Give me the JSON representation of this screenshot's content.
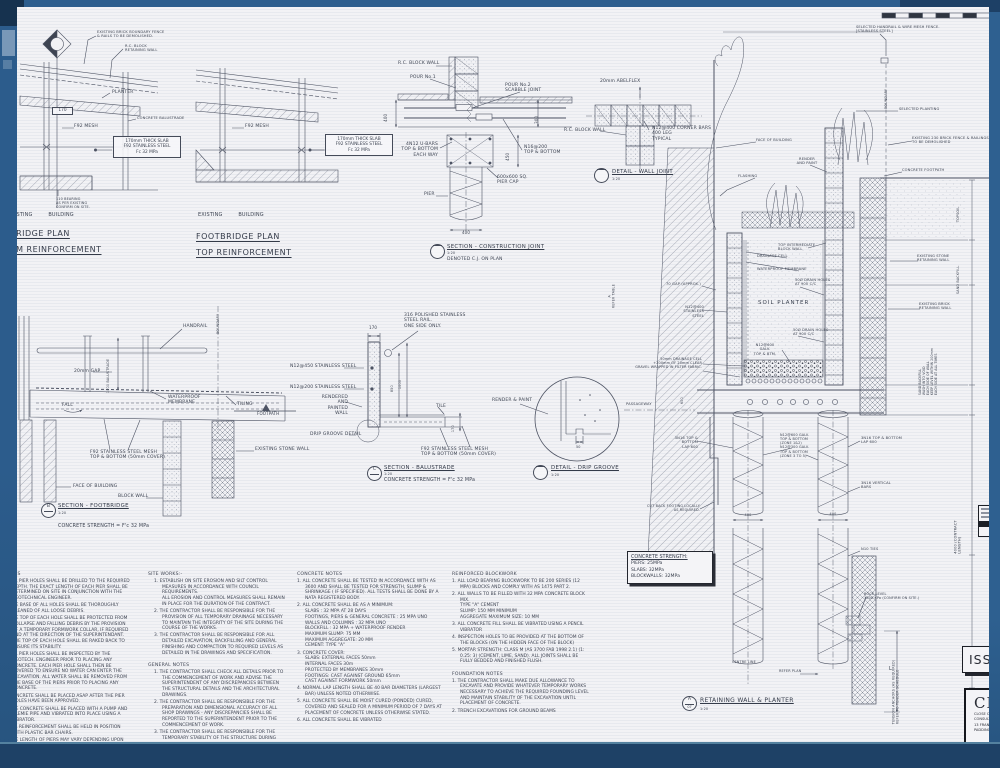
{
  "frame": {
    "border_color": "#2d5e8e",
    "dark_color": "#16324f",
    "paper_color": "#f2f2f5",
    "ink_color": "#3d4452"
  },
  "plan_bottom": {
    "callout_fence": "EXISTING BRICK BOUNDARY FENCE\n& RAILS TO BE DEMOLISHED.",
    "callout_rc_wall": "R.C. BLOCK\nRETAINING WALL",
    "label_planter": "PLANTER",
    "dim_thickness": "170",
    "label_mesh": "F92 MESH",
    "callout_balustrade": "CONCRETE BALUSTRADE",
    "note_slab": "170mm THICK SLAB\nF92 STAINLESS STEEL\nFc 32 MPa",
    "callout_bearing": "110 BEARING\nAS PER EXISTING\nCONFIRM ON SITE.",
    "label_existing_building": "EXISTING BUILDING",
    "title": "FOOTBRIDGE PLAN",
    "subtitle": "BOTTOM REINFORCEMENT"
  },
  "plan_top": {
    "label_mesh": "F92 MESH",
    "note_slab": "170mm THICK SLAB\nF92 STAINLESS STEEL\nFc 32 MPa",
    "label_existing_building": "EXISTING BUILDING",
    "title": "FOOTBRIDGE PLAN",
    "subtitle": "TOP REINFORCEMENT"
  },
  "section_cj": {
    "callout_wall": "R.C. BLOCK WALL",
    "callout_pour1": "POUR No.1",
    "callout_pour2": "POUR No.2\nSCABBLE JOINT",
    "callout_ubars": "4N12 U-BARS\nTOP & BOTTOM\nEACH WAY",
    "callout_n16": "N16@200\nTOP & BOTTOM",
    "callout_piercap": "600x600 SQ.\nPIER CAP",
    "callout_pier": "PIER",
    "dim_400": "400",
    "dim_300": "300",
    "dim_450": "450",
    "dim_400b": "400",
    "title": "SECTION - CONSTRUCTION JOINT",
    "scale": "1:20",
    "note": "DENOTED C.J. ON PLAN"
  },
  "detail_wall_joint": {
    "callout_abelflex": "20mm ABELFLEX",
    "callout_wall": "R.C. BLOCK WALL",
    "callout_corner_bars": "N12@400 CORNER BARS\n400 LEG\nTYPICAL",
    "title": "DETAIL - WALL JOINT",
    "scale": "1:20"
  },
  "section_footbridge": {
    "callout_handrail": "HANDRAIL",
    "label_boundary": "BOUNDARY",
    "callout_gap": "20mm GAP",
    "dim_balustrade": "1000 BALUSTRADE",
    "label_fall": "FALL",
    "callout_membrane": "WATERPROOF\nMEMBRANE",
    "callout_tiling": "TILING",
    "label_footpath": "FOOTPATH",
    "callout_mesh": "F92 STAINLESS STEEL MESH\nTOP & BOTTOM (50mm COVER)",
    "callout_face": "FACE OF BUILDING",
    "callout_blockwall": "BLOCK WALL",
    "callout_stonewall": "EXISTING STONE WALL",
    "bubble_letter": "B",
    "title": "SECTION - FOOTBRIDGE",
    "scale": "1:20",
    "strength": "CONCRETE STRENGTH = F'c 32 MPa"
  },
  "section_balustrade": {
    "callout_rail": "316 POLISHED STAINLESS\nSTEEL RAIL.\nONE SIDE ONLY.",
    "dim_top": "170",
    "callout_n12_450": "N12@450 STAINLESS STEEL",
    "callout_n12_200": "N12@200 STAINLESS STEEL",
    "callout_rendered": "RENDERED AND\nPAINTED WALL",
    "dim_850": "850",
    "dim_1000": "1000",
    "callout_drip": "DRIP GROOVE DETAIL",
    "callout_tile": "TILE",
    "dim_170": "170",
    "callout_mesh": "F92 STAINLESS STEEL MESH\nTOP & BOTTOM (50mm COVER)",
    "bubble_letter": "C",
    "title": "SECTION - BALUSTRADE",
    "scale": "1:20",
    "strength": "CONCRETE STRENGTH = F'c 32 MPa"
  },
  "detail_drip": {
    "callout_render": "RENDER & PAINT",
    "dim_50": "50",
    "title": "DETAIL - DRIP GROOVE",
    "scale": "1:20"
  },
  "section_retaining": {
    "callout_fence": "SELECTED HANDRAIL & WIRE MESH FENCE.\n[STAINLESS STEEL]",
    "label_boundary": "BOUNDARY",
    "callout_planting": "SELECTED PLANTING",
    "callout_brick_fence": "EXISTING 230 BRICK FENCE & RAILINGS\nTO BE DEMOLISHED",
    "callout_footpath": "CONCRETE FOOTPATH",
    "callout_face": "FACE OF BUILDING",
    "callout_render": "RENDER\nAND PAINT",
    "callout_flashing": "FLASHING",
    "callout_top_wall": "TOP INTERMEDIATE\nBLOCK WALL",
    "callout_drainage_cell": "DRAINAGE CELL",
    "callout_membrane": "WATERPROOF MEMBRANE",
    "callout_gap": "70 GAP (APPROX.)",
    "callout_n12_ss": "N12@400\nSTAINLESS STEEL",
    "label_soil": "SOIL PLANTER",
    "callout_drain1": "50Ø DRAIN HOLES\nAT 900 C/C",
    "callout_drain2": "50Ø DRAIN HOLES\nAT 900 C/C",
    "callout_n12_galv": "N12@600 GALV.\nTOP & BTM.",
    "callout_drainage": "50mm DRAINAGE CELL\n+200mm OF 20mm CLEAR\nGRAVEL WRAPPED IN FILTER FABRIC.",
    "label_passageway": "PASSAGEWAY",
    "dim_600": "600",
    "dim_refer": "A\nREFER TABLE",
    "callout_3n16_left": "3N16 TOP & BOTTOM\nLAP 600",
    "callout_zone": "N12@600 GALV.\nTOP & BOTTOM\n(ZONE 1&2)\nN12@300 GALV.\nTOP & BOTTOM\n(ZONE 3 TO 5)",
    "callout_3n16_right": "3N16 TOP & BOTTOM\nLAP 600",
    "callout_vert_bars": "3N16 VERTICAL\nBARS",
    "callout_cutback": "CUT BACK FOOTING LOCALLY\nAS REQUIRED.",
    "dim_400_left": "400",
    "dim_400_right": "400",
    "callout_ties": "N10 TIES",
    "callout_rock": "ROCK LEVEL\n1000 KPa (CONFIRM ON SITE.)",
    "label_centreline": "CENTRE LINE",
    "label_refer_plan": "REFER PLAN",
    "dim_L": "L",
    "label_anchors": "TENSION ANCHORS (AS REQUIRED)\nREFER TO TENDER SCHEDULE",
    "dim_contract": "4000 (CONTRACT LENGTH)",
    "label_topsoil": "TOPSOIL",
    "label_sand": "SAND BACKFILL",
    "callout_stone_wall": "EXISTING STONE\nRETAINING WALL",
    "callout_brick_wall": "EXISTING BRICK\nRETAINING WALL",
    "label_backfill_note": "SAND BACKFILL\nWASH INTO VOID\nEACH SIDE OF WALL\nKEEP LEVEL WITHIN 200mm\nEACH SIDE AT ALL TIMES",
    "bubble_letter": "A",
    "bubble_number": "07",
    "title": "RETAINING WALL & PLANTER",
    "scale": "1:20"
  },
  "strength_box": {
    "heading": "CONCRETE STRENGTH:",
    "piers": "PIERS: 25MPa",
    "slabs": "SLABS: 32MPa",
    "blockwalls": "BLOCKWALLS: 32MPa"
  },
  "notes": {
    "pier": {
      "heading": "NOTES",
      "items": [
        "1. ALL PIER HOLES SHALL BE DRILLED TO THE REQUIRED DEPTH. THE EXACT LENGTH OF EACH PIER SHALL BE DETERMINED ON SITE IN CONJUNCTION WITH THE GEOTECHNICAL ENGINEER.",
        "2. THE BASE OF ALL HOLES SHALL BE THOROUGHLY CLEANED OF ALL LOOSE DEBRIS.",
        "3. THE TOP OF EACH HOLE SHALL BE PROTECTED FROM COLLAPSE AND FALLING DEBRIS BY THE PROVISION OF A TEMPORARY FORMWORK COLLAR, IF REQUIRED AND AT THE DIRECTION OF THE SUPERINTENDANT. THE TOP OF EACH HOLE SHALL BE RAKED BACK TO ENSURE ITS STABILITY.",
        "4. ALL PIER HOLES SHALL BE INSPECTED BY THE GEOTECH. ENGINEER PRIOR TO PLACING ANY CONCRETE. EACH PIER HOLE SHALL THEN BE COVERED TO ENSURE NO WATER CAN ENTER THE EXCAVATION. ALL WATER SHALL BE REMOVED FROM THE BASE OF THE PIERS PRIOR TO PLACING ANY CONCRETE.",
        "5. CONCRETE SHALL BE PLACED ASAP AFTER THE PIER HOLES HAVE BEEN APPROVED.",
        "6. THE CONCRETE SHALL BE PLACED WITH A PUMP AND TREMIE PIPE AND VIBRATED INTO PLACE USING A VIBRATOR.",
        "7. ALL REINFORCEMENT SHALL BE HELD IN POSITION WITH PLASTIC BAR CHAIRS.",
        "8. THE LENGTH OF PIERS MAY VARY DEPENDING UPON"
      ]
    },
    "site": {
      "heading": "SITE WORKS:-",
      "items": [
        "1. ESTABLISH ON SITE EROSION AND SILT CONTROL MEASURES IN ACCORDANCE WITH COUNCIL REQUIREMENTS.\nALL EROSION AND CONTROL MEASURES SHALL REMAIN IN PLACE FOR THE DURATION OF THE CONTRACT.",
        "2. THE CONTRACTOR SHALL BE RESPONSIBLE FOR THE PROVISION OF ALL TEMPORARY DRAINAGE NECESSARY TO MAINTAIN THE INTEGRITY OF THE SITE DURING THE COURSE OF THE WORKS.",
        "3. THE CONTRACTOR SHALL BE RESPONSIBLE FOR ALL DETAILED EXCAVATION, BACKFILLING AND GENERAL FINISHING AND COMPACTION TO REQUIRED LEVELS AS DETAILED IN THE DRAWINGS AND SPECIFICATION."
      ]
    },
    "general": {
      "heading": "GENERAL NOTES",
      "items": [
        "1. THE CONTRACTOR SHALL CHECK ALL DETAILS PRIOR TO THE COMMENCEMENT OF WORK AND ADVISE THE SUPERINTENDENT OF ANY DISCREPANCIES BETWEEN THE STRUCTURAL DETAILS AND THE ARCHITECTURAL DRAWINGS.",
        "2. THE CONTRACTOR SHALL BE RESPONSIBLE FOR THE PREPARATION AND DIMENSIONAL ACCURACY OF ALL SHOP DRAWINGS - ANY DISCREPANCIES SHALL BE REPORTED TO THE SUPERINTENDENT PRIOR TO THE COMMENCEMENT OF WORK.",
        "3. THE CONTRACTOR SHALL BE RESPONSIBLE FOR THE TEMPORARY STABILITY OF THE STRUCTURE DURING"
      ]
    },
    "concrete": {
      "heading": "CONCRETE NOTES",
      "items": [
        "1. ALL CONCRETE SHALL BE TESTED IN ACCORDANCE WITH AS 3600 AND SHALL BE TESTED FOR STRENGTH, SLUMP & SHRINKAGE ( IF SPECIFIED). ALL TESTS SHALL BE DONE BY A NATA REGISTERED BODY.",
        "2. ALL CONCRETE SHALL BE AS A MINIMUM:\nSLABS : 32 MPA AT 28 DAYS\nFOOTINGS, PIERS & GENERAL CONCRETE : 25 MPA UNO\nWALLS AND COLUMNS : 32 MPA UNO\nBLOCKFILL : 32 MPA + WATERPROOF RENDER\nMAXIMUM SLUMP: 75 MM\nMAXIMUM AGGREGATE: 20 MM\nCEMENT: TYPE \"A\"",
        "3. CONCRETE COVER:\nSLABS: EXTERNAL FACES 50mm\nINTERNAL FACES 30m\nPROTECTED BY MEMBRANES 30mm\nFOOTINGS: CAST AGAINST GROUND 65mm\nCAST AGAINST FORMWORK 50mm",
        "4. NORMAL LAP LENGTH SHALL BE 40 BAR DIAMETERS (LARGEST BAR) UNLESS NOTED OTHERWISE.",
        "5. ALL CONCRETE SHALL BE MOIST CURED (PONDED) CURED, COVERED AND SEALED FOR A MINIMUM PERIOD OF 7 DAYS AT PLACEMENT OF CONCRETE UNLESS OTHERWISE STATED.",
        "6. ALL CONCRETE SHALL BE VIBRATED"
      ]
    },
    "blockwork": {
      "heading": "REINFORCED BLOCKWORK",
      "items": [
        "1. ALL LOAD BEARING BLOCKWORK TO BE 200 SERIES (12 MPA) BLOCKS AND COMPLY WITH AS 1475 PART 2.",
        "2. ALL WALLS TO BE FILLED WITH 32 MPA CONCRETE BLOCK MIX.\nTYPE \"A\" CEMENT\nSLUMP: 150 MM MINIMUM\nAGGREGATE MAXIMUM SIZE: 10 MM",
        "3. ALL CONCRETE FILL SHALL BE VIBRATED USING A PENCIL VIBRATOR",
        "4. INSPECTION HOLES TO BE PROVIDED AT THE BOTTOM OF THE BLOCKS (ON THE HIDDEN FACE OF THE BLOCK)",
        "5. MORTAR STRENGTH: CLASS M (AS 3700 FAB 1998 2.1) (1: 0.25: 3) (CEMENT, LIME, SAND). ALL JOINTS SHALL BE FULLY BEDDED AND FINISHED FLUSH."
      ]
    },
    "foundation": {
      "heading": "FOUNDATION NOTES",
      "items": [
        "1. THE CONTRACTOR SHALL MAKE DUE ALLOWANCE TO EXCAVATE AND PROVIDE WHATEVER TEMPORARY WORKS NECESSARY TO ACHIEVE THE REQUIRED FOUNDING LEVEL AND MAINTAIN STABILITY OF THE EXCAVATION UNTIL PLACEMENT OF CONCRETE.",
        "2. TRENCH EXCAVATIONS FOR GROUND BEAMS"
      ]
    }
  },
  "titleblock": {
    "issue": "ISSUE",
    "logo": "CL",
    "line1": "CLOSE C",
    "line2": "CONSULTIN",
    "line3": "13 FRAN",
    "line4": "PADDINGT"
  }
}
